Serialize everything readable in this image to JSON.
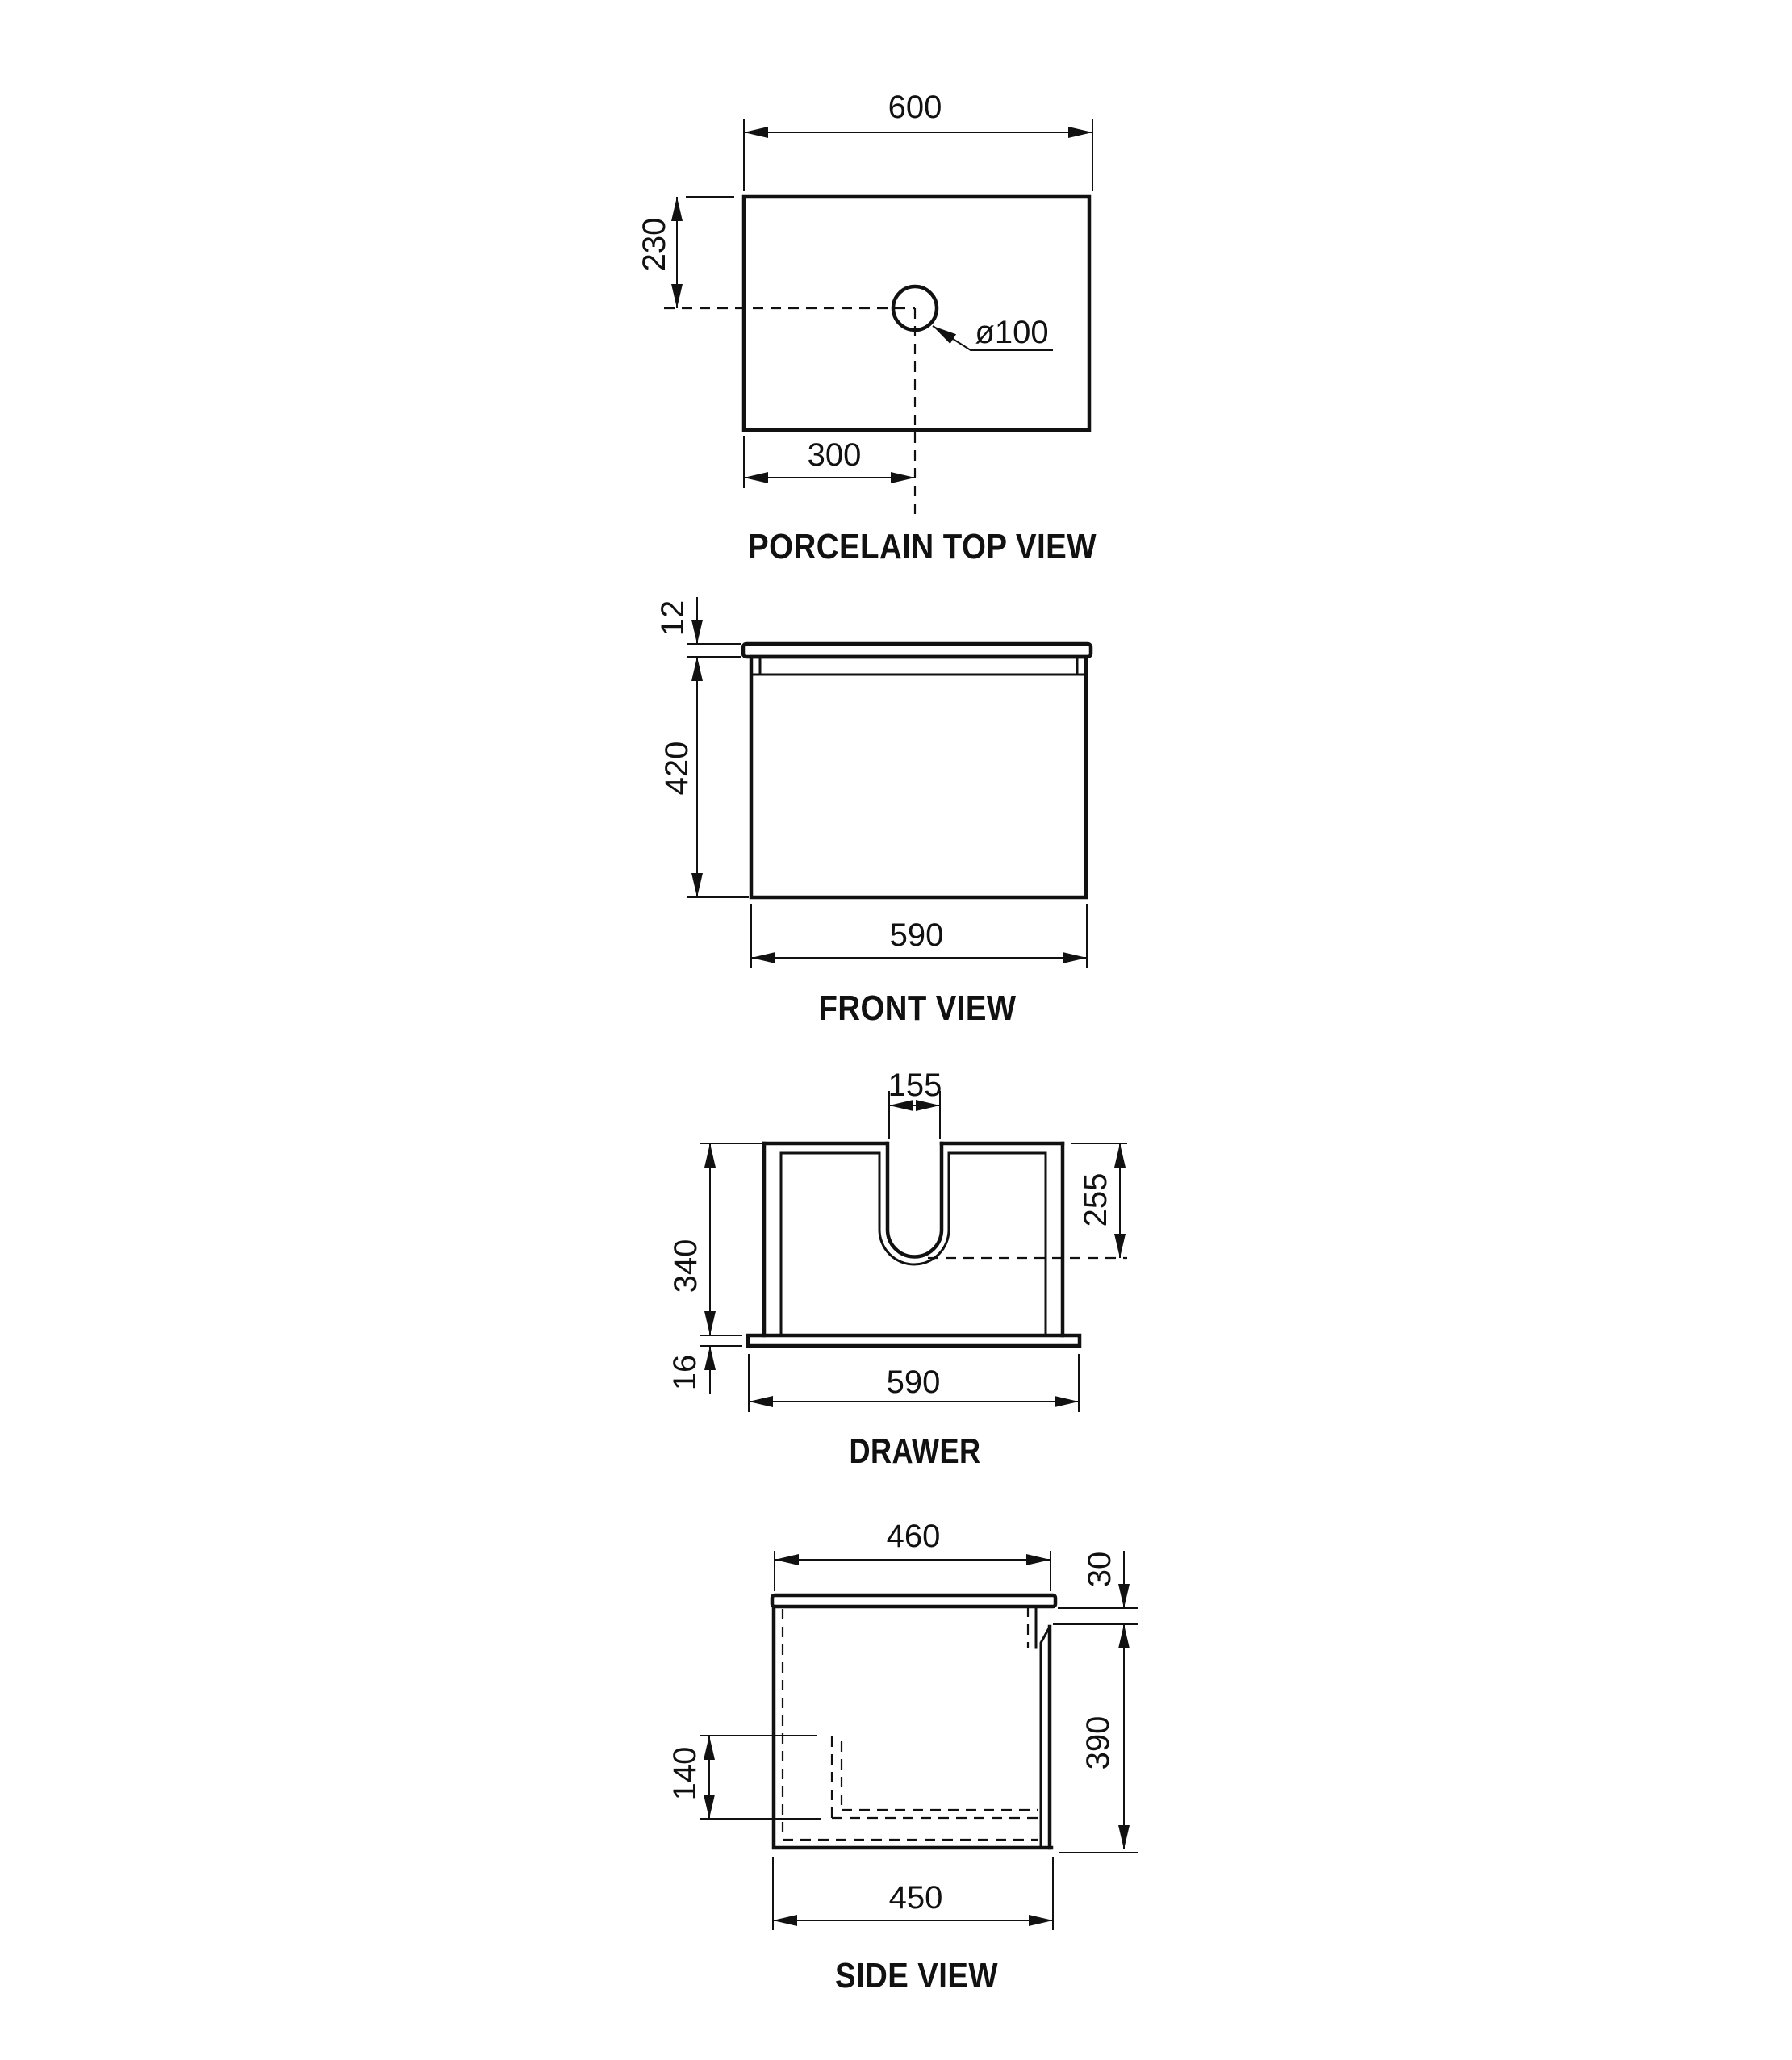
{
  "page": {
    "background": "#ffffff",
    "line_color": "#111111"
  },
  "views": {
    "top": {
      "title": "PORCELAIN TOP VIEW",
      "dim_width": "600",
      "dim_hole_top": "230",
      "dim_hole_left": "300",
      "dim_hole_dia": "ø100"
    },
    "front": {
      "title": "FRONT VIEW",
      "dim_top_thickness": "12",
      "dim_height": "420",
      "dim_width": "590"
    },
    "drawer": {
      "title": "DRAWER",
      "dim_notch_width": "155",
      "dim_height": "340",
      "dim_notch_depth": "255",
      "dim_base_thickness": "16",
      "dim_width": "590"
    },
    "side": {
      "title": "SIDE VIEW",
      "dim_top_depth": "460",
      "dim_gap": "30",
      "dim_height": "390",
      "dim_inner_height": "140",
      "dim_depth": "450"
    }
  }
}
